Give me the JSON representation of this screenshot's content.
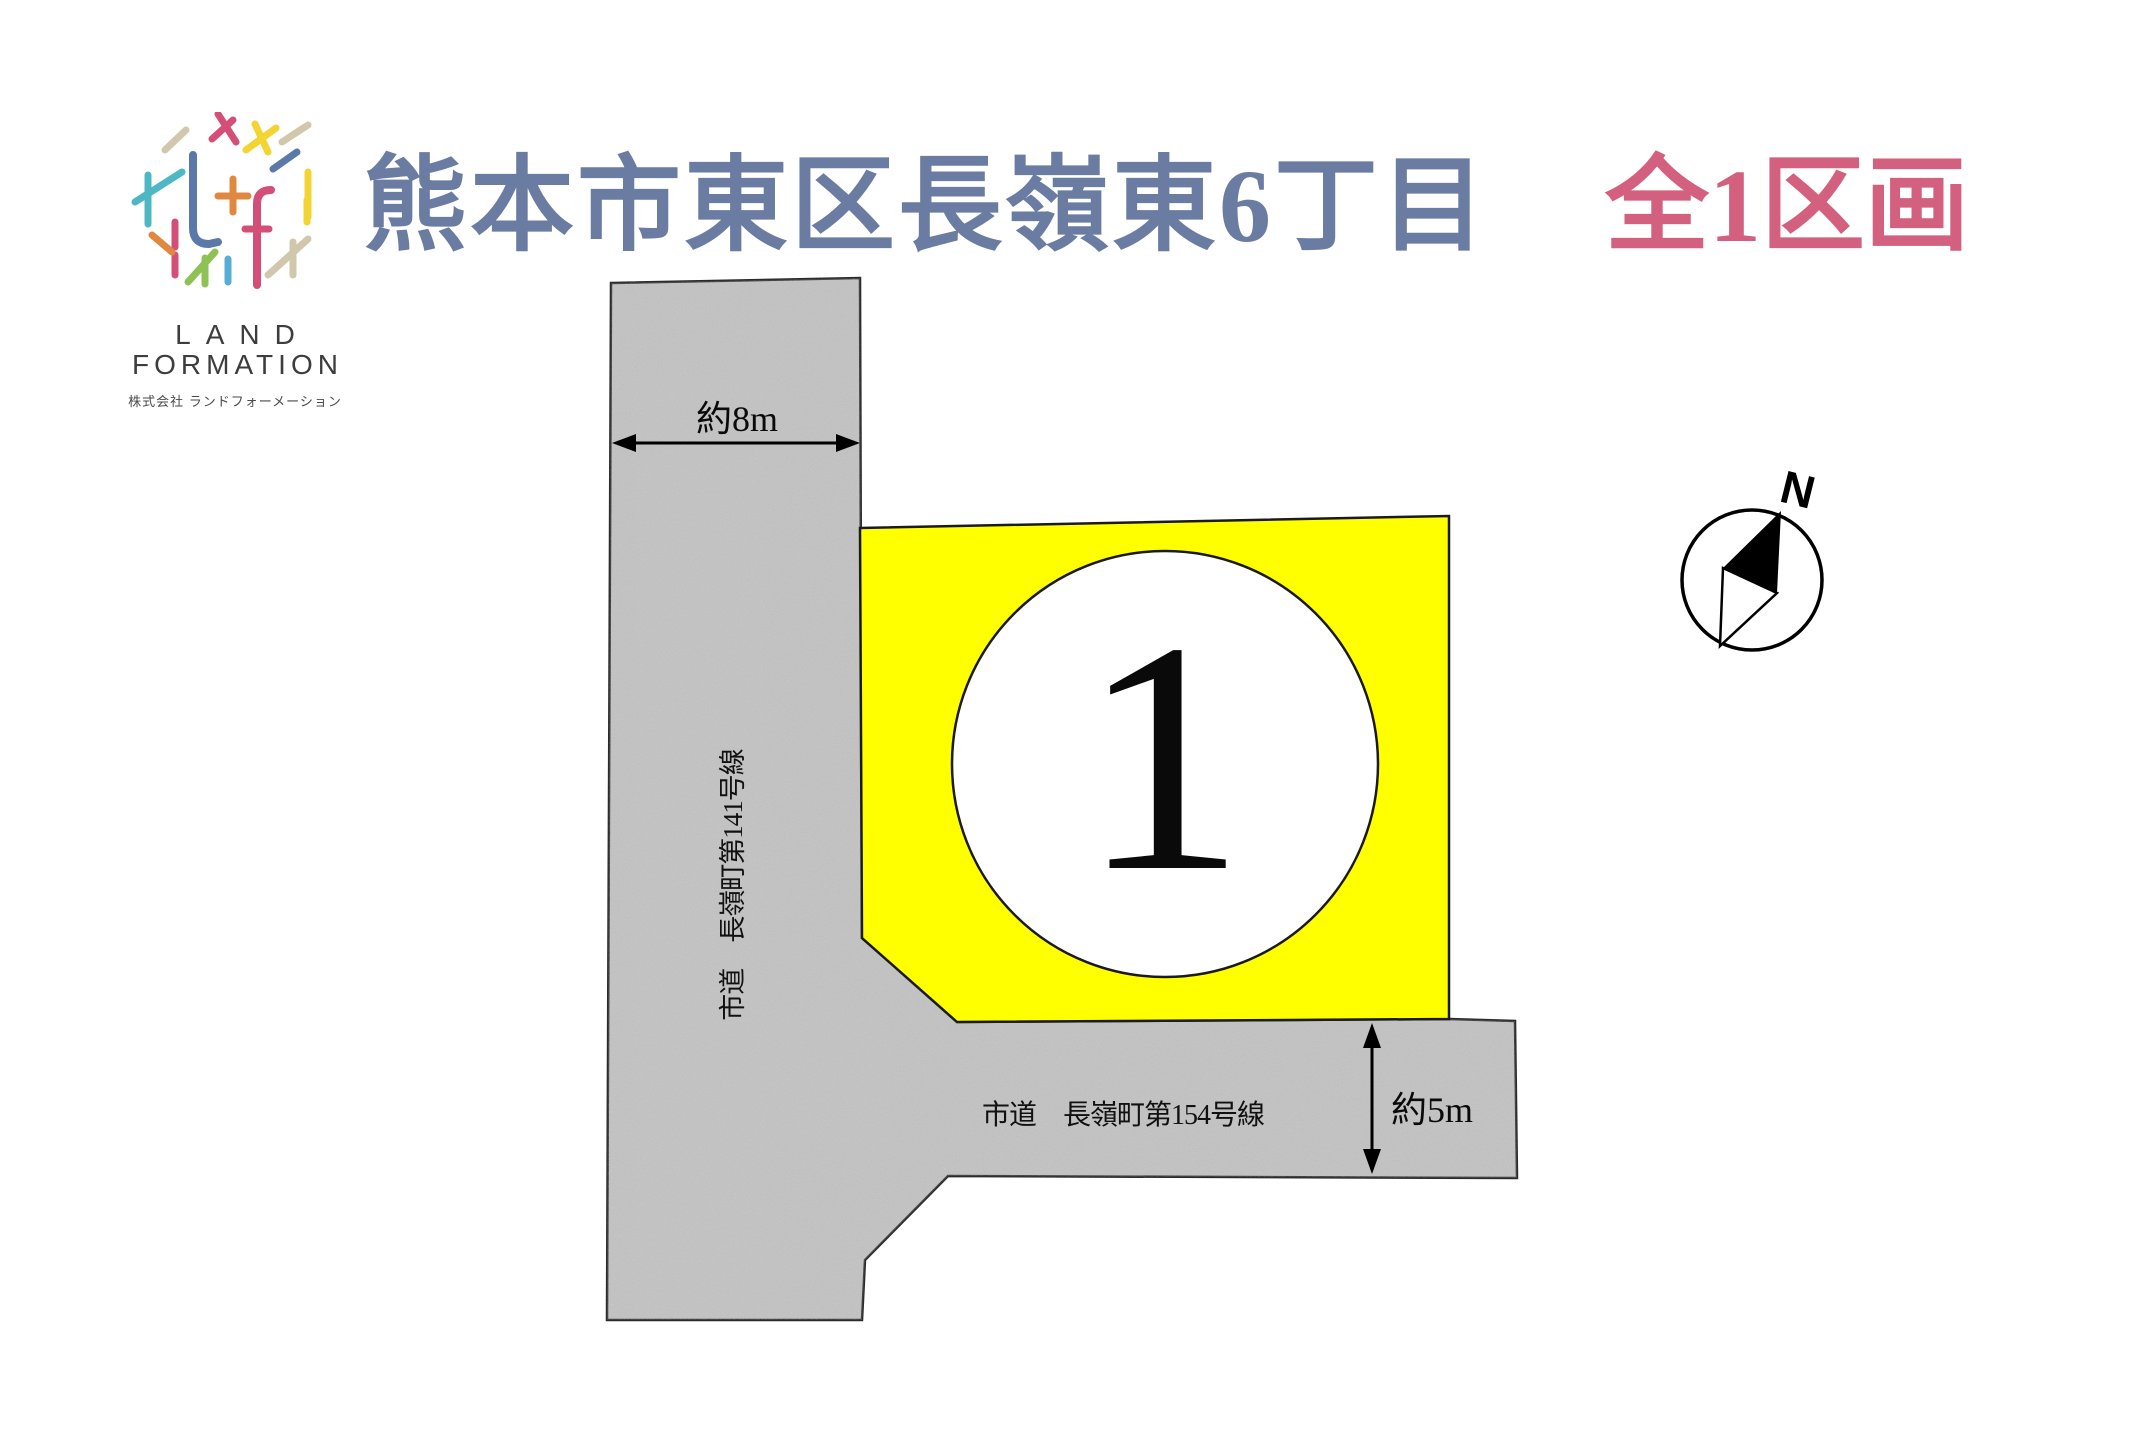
{
  "header": {
    "logo": {
      "word1": "LAND",
      "word2": "FORMATION",
      "company": "株式会社 ランドフォーメーション"
    },
    "title": "熊本市東区長嶺東6丁目",
    "subtitle": "全1区画",
    "title_color": "#6b7ca3",
    "subtitle_color": "#d2607e"
  },
  "diagram": {
    "plot": {
      "number": "1",
      "fill_color": "#ffff00"
    },
    "road_fill_color": "#c8c8c8",
    "road_outline_color": "#2a2a2a",
    "roads": [
      {
        "name": "vertical-road",
        "label": "市道　長嶺町第141号線",
        "width_label": "約8m"
      },
      {
        "name": "horizontal-road",
        "label": "市道　長嶺町第154号線",
        "width_label": "約5m"
      }
    ],
    "compass": {
      "north_label": "N"
    }
  }
}
